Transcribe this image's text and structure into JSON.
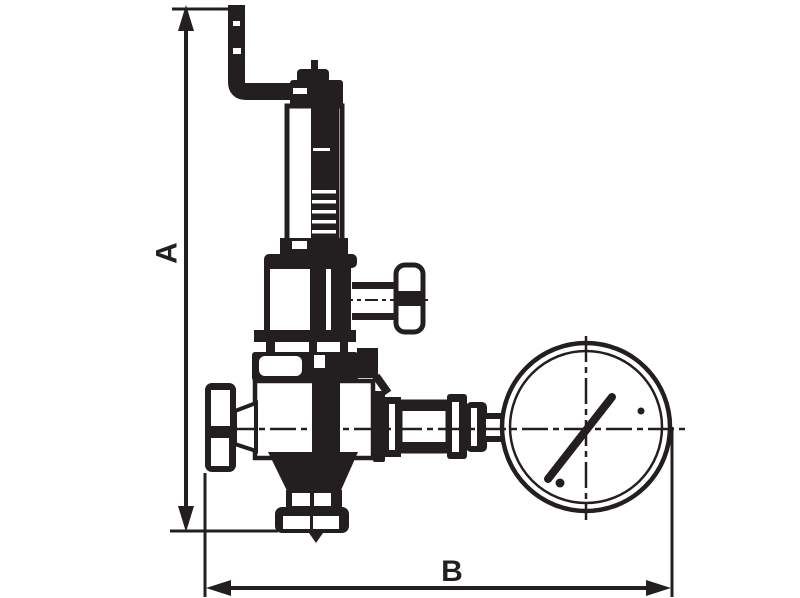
{
  "drawing": {
    "type": "technical-line-drawing",
    "subject": "pressure reducing valve with elbow pipe and pressure gauge",
    "labels": {
      "height_dimension": "A",
      "width_dimension": "B"
    },
    "colors": {
      "ink": "#231f20",
      "background": "#ffffff"
    }
  }
}
